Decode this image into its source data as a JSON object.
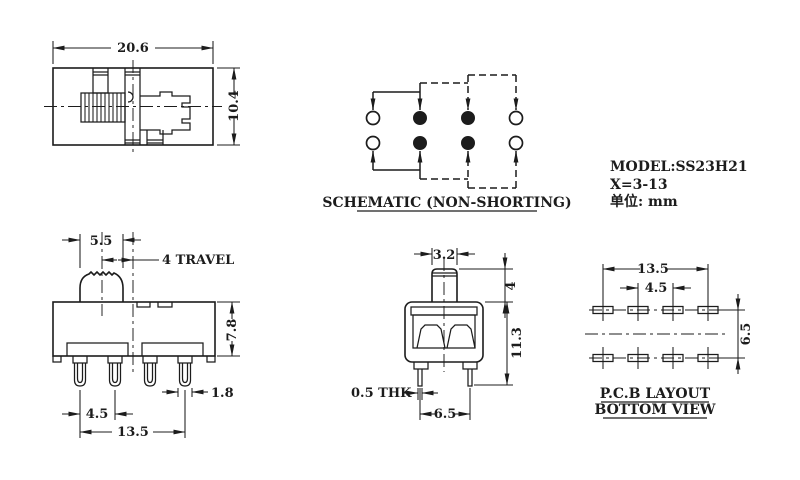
{
  "views": {
    "top_view": {
      "dims": {
        "width": "20.6",
        "height": "10.4"
      }
    },
    "schematic": {
      "title": "SCHEMATIC (NON-SHORTING)"
    },
    "model_info": {
      "model": "MODEL:SS23H21",
      "x_range": "X=3-13",
      "unit": "单位: mm"
    },
    "front_view": {
      "dims": {
        "knob_width": "5.5",
        "travel": "4 TRAVEL",
        "body_height": "7.8",
        "pin_width": "1.8",
        "pin_pitch": "4.5",
        "pin_span": "13.5"
      }
    },
    "side_view": {
      "dims": {
        "knob_width": "3.2",
        "knob_height": "4",
        "total_height": "11.3",
        "pin_thickness": "0.5 THK",
        "pin_spacing": "6.5"
      }
    },
    "pcb_layout": {
      "dims": {
        "pad_span": "13.5",
        "pad_pitch": "4.5",
        "row_spacing": "6.5"
      },
      "title_line1": "P.C.B LAYOUT",
      "title_line2": "BOTTOM VIEW"
    }
  },
  "colors": {
    "line": "#1c1c1c",
    "background": "#ffffff"
  }
}
